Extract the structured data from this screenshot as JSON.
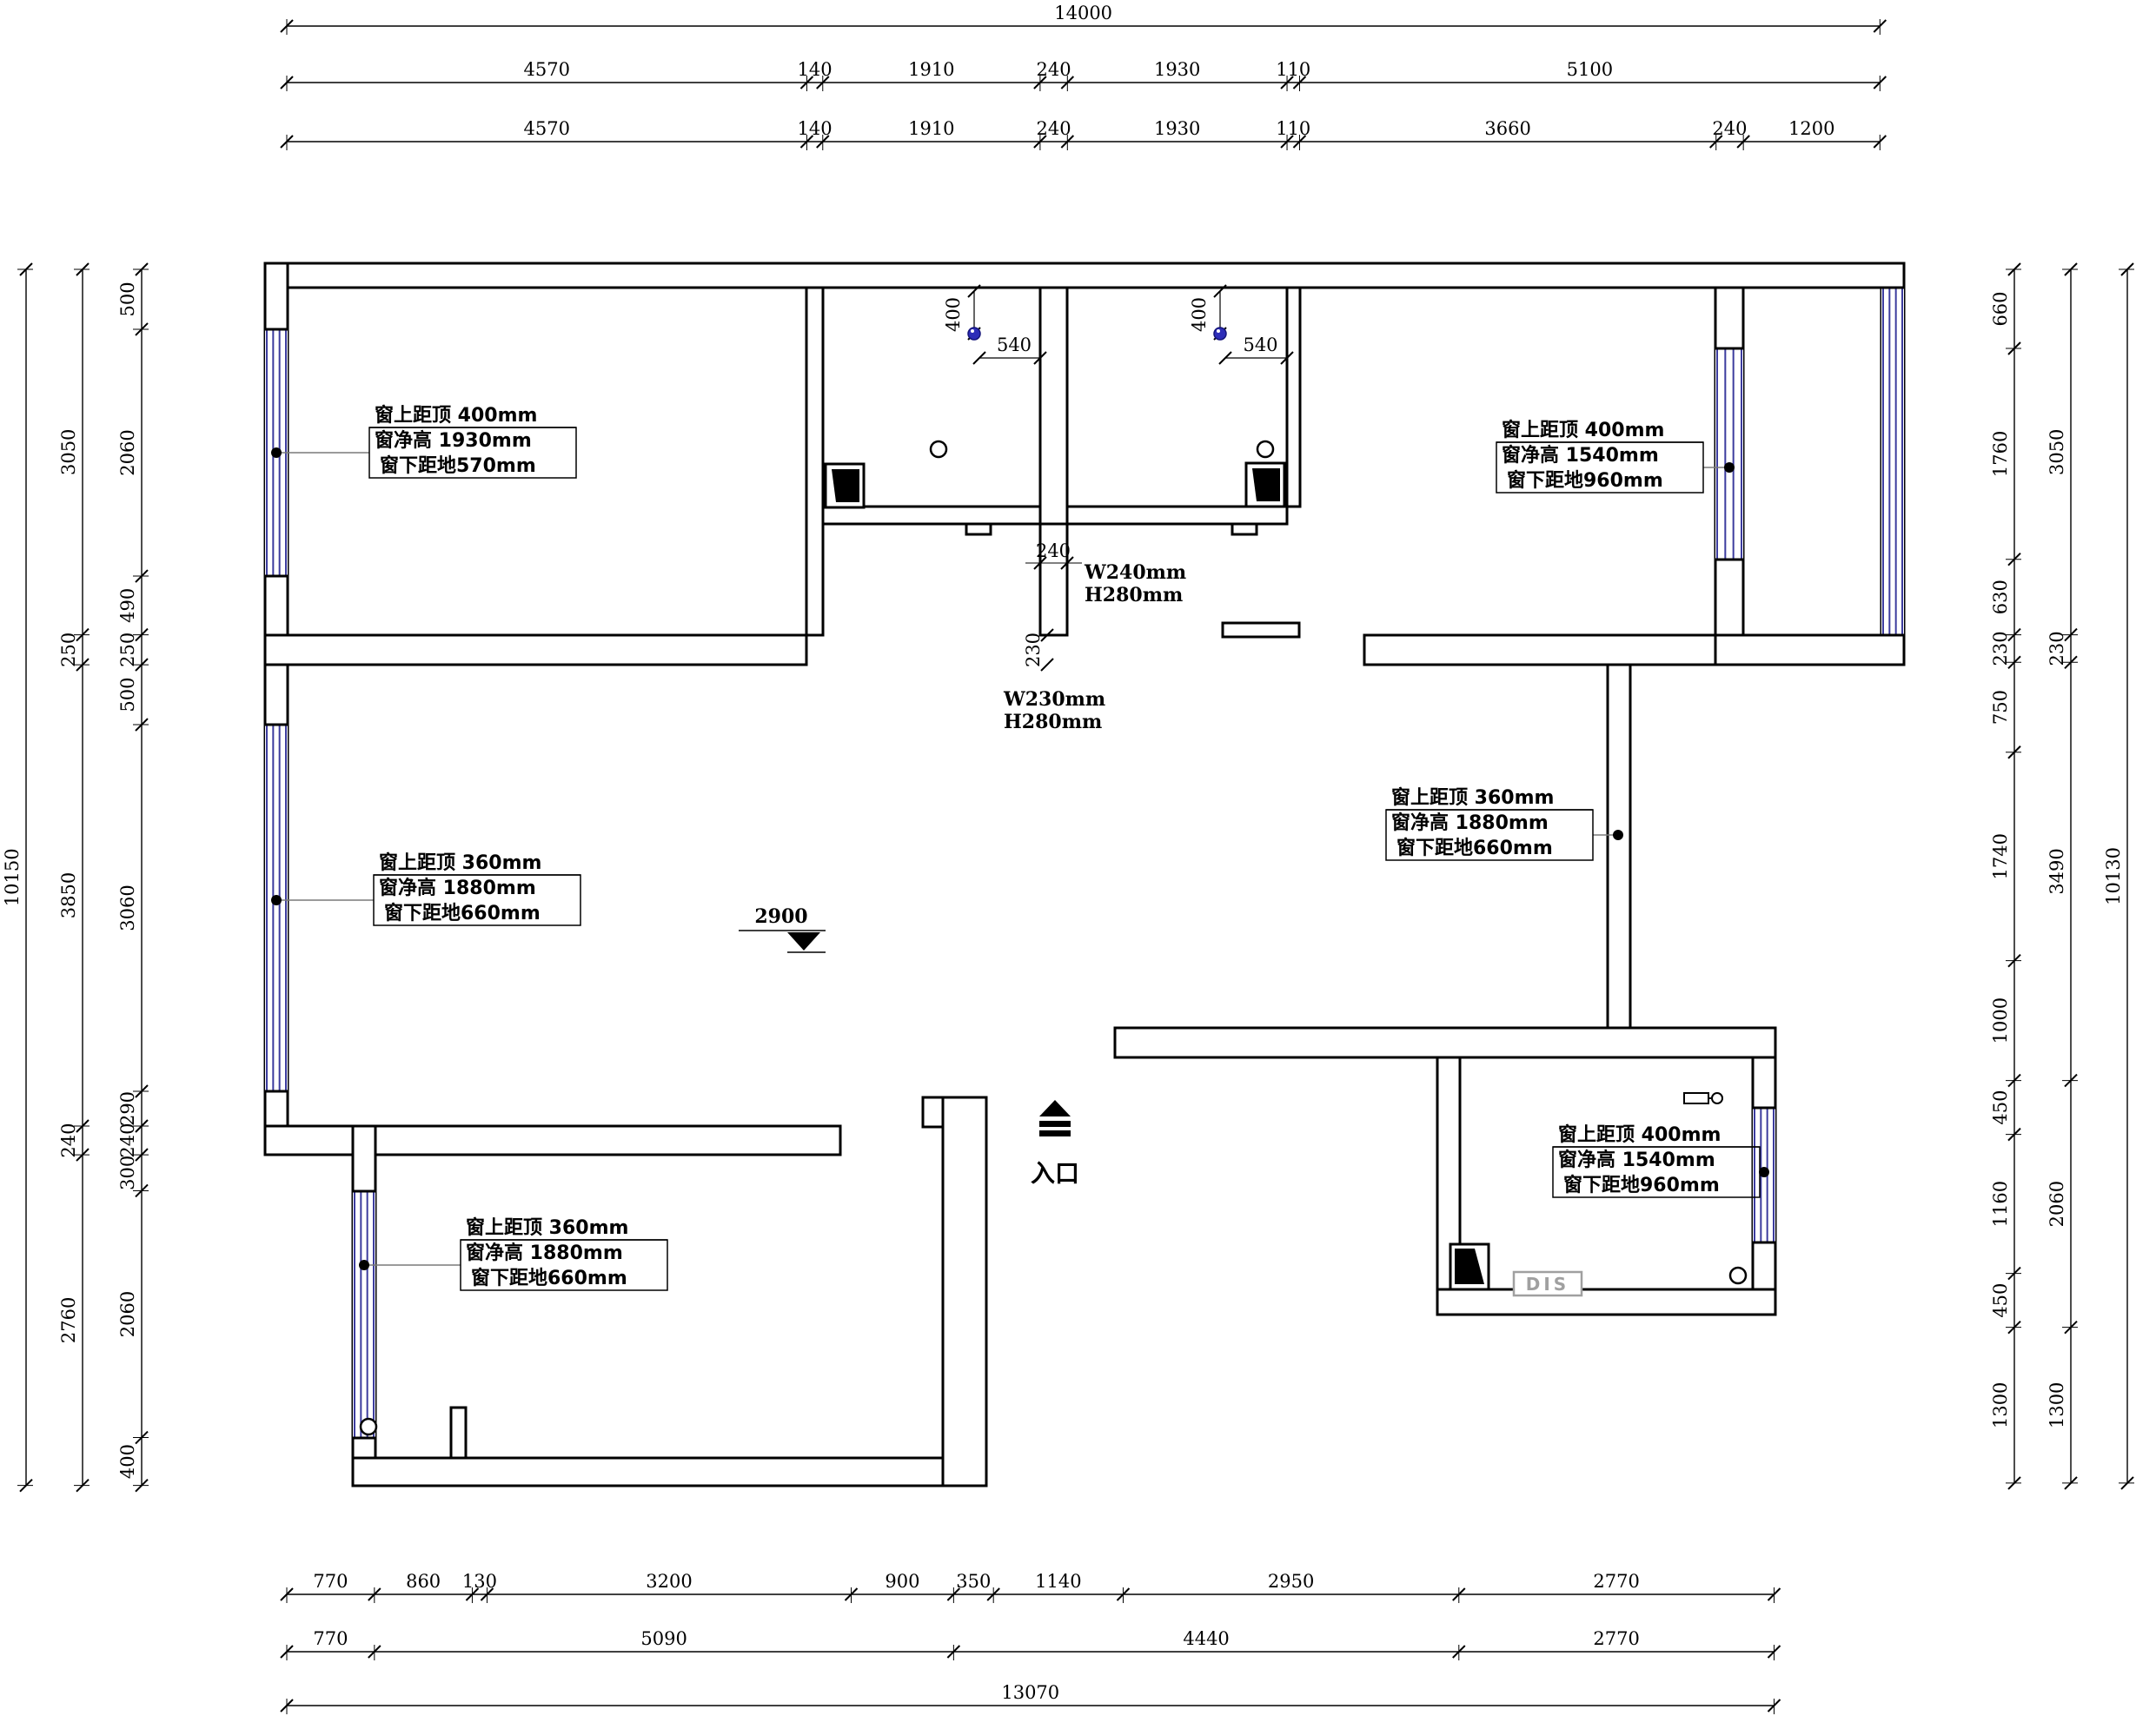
{
  "drawing": {
    "background": "#ffffff",
    "wall_color": "#000000",
    "window_color": "#3c3c9e",
    "accent_blue": "#2d2db8",
    "leader_color": "#7a7a7a",
    "dis_color": "#a0a0a0"
  },
  "dimensions": {
    "top_total": [
      14000
    ],
    "top_row2": [
      4570,
      140,
      1910,
      240,
      1930,
      110,
      5100
    ],
    "top_row3": [
      4570,
      140,
      1910,
      240,
      1930,
      110,
      3660,
      240,
      1200
    ],
    "bottom_row1": [
      770,
      860,
      130,
      3200,
      900,
      350,
      1140,
      2950,
      2770
    ],
    "bottom_row2": [
      770,
      5090,
      4440,
      2770
    ],
    "bottom_total": [
      13070
    ],
    "left_outer": [
      10150
    ],
    "left_middle": [
      3050,
      250,
      3850,
      240,
      2760
    ],
    "left_inner": [
      500,
      2060,
      490,
      250,
      500,
      3060,
      290,
      240,
      300,
      2060,
      400
    ],
    "right_inner": [
      660,
      1760,
      630,
      230,
      750,
      1740,
      1000,
      450,
      1160,
      450,
      1300
    ],
    "right_middle": [
      3050,
      230,
      3490,
      2060,
      1300
    ],
    "right_outer": [
      10130
    ]
  },
  "window_annotations": [
    {
      "id": "bedroom1-left",
      "top": "窗上距顶 400mm",
      "height": "窗净高  1930mm",
      "bottom": "窗下距地570mm"
    },
    {
      "id": "bedroom2-right",
      "top": "窗上距顶 400mm",
      "height": "窗净高  1540mm",
      "bottom": "窗下距地960mm"
    },
    {
      "id": "living-left",
      "top": "窗上距顶 360mm",
      "height": "窗净高  1880mm",
      "bottom": "窗下距地660mm"
    },
    {
      "id": "dining-right",
      "top": "窗上距顶 360mm",
      "height": "窗净高  1880mm",
      "bottom": "窗下距地660mm"
    },
    {
      "id": "room-bottom-right",
      "top": "窗上距顶 400mm",
      "height": "窗净高  1540mm",
      "bottom": "窗下距地960mm"
    },
    {
      "id": "room-bottom-left",
      "top": "窗上距顶 360mm",
      "height": "窗净高  1880mm",
      "bottom": "窗下距地660mm"
    }
  ],
  "openings": [
    {
      "dim": "240",
      "w": "W240mm",
      "h": "H280mm"
    },
    {
      "dim": "230",
      "w": "W230mm",
      "h": "H280mm"
    }
  ],
  "bath_dims": {
    "vertical": "400",
    "horizontal": "540"
  },
  "labels": {
    "elevation": "2900",
    "entrance": "入口",
    "dis": "DIS"
  }
}
